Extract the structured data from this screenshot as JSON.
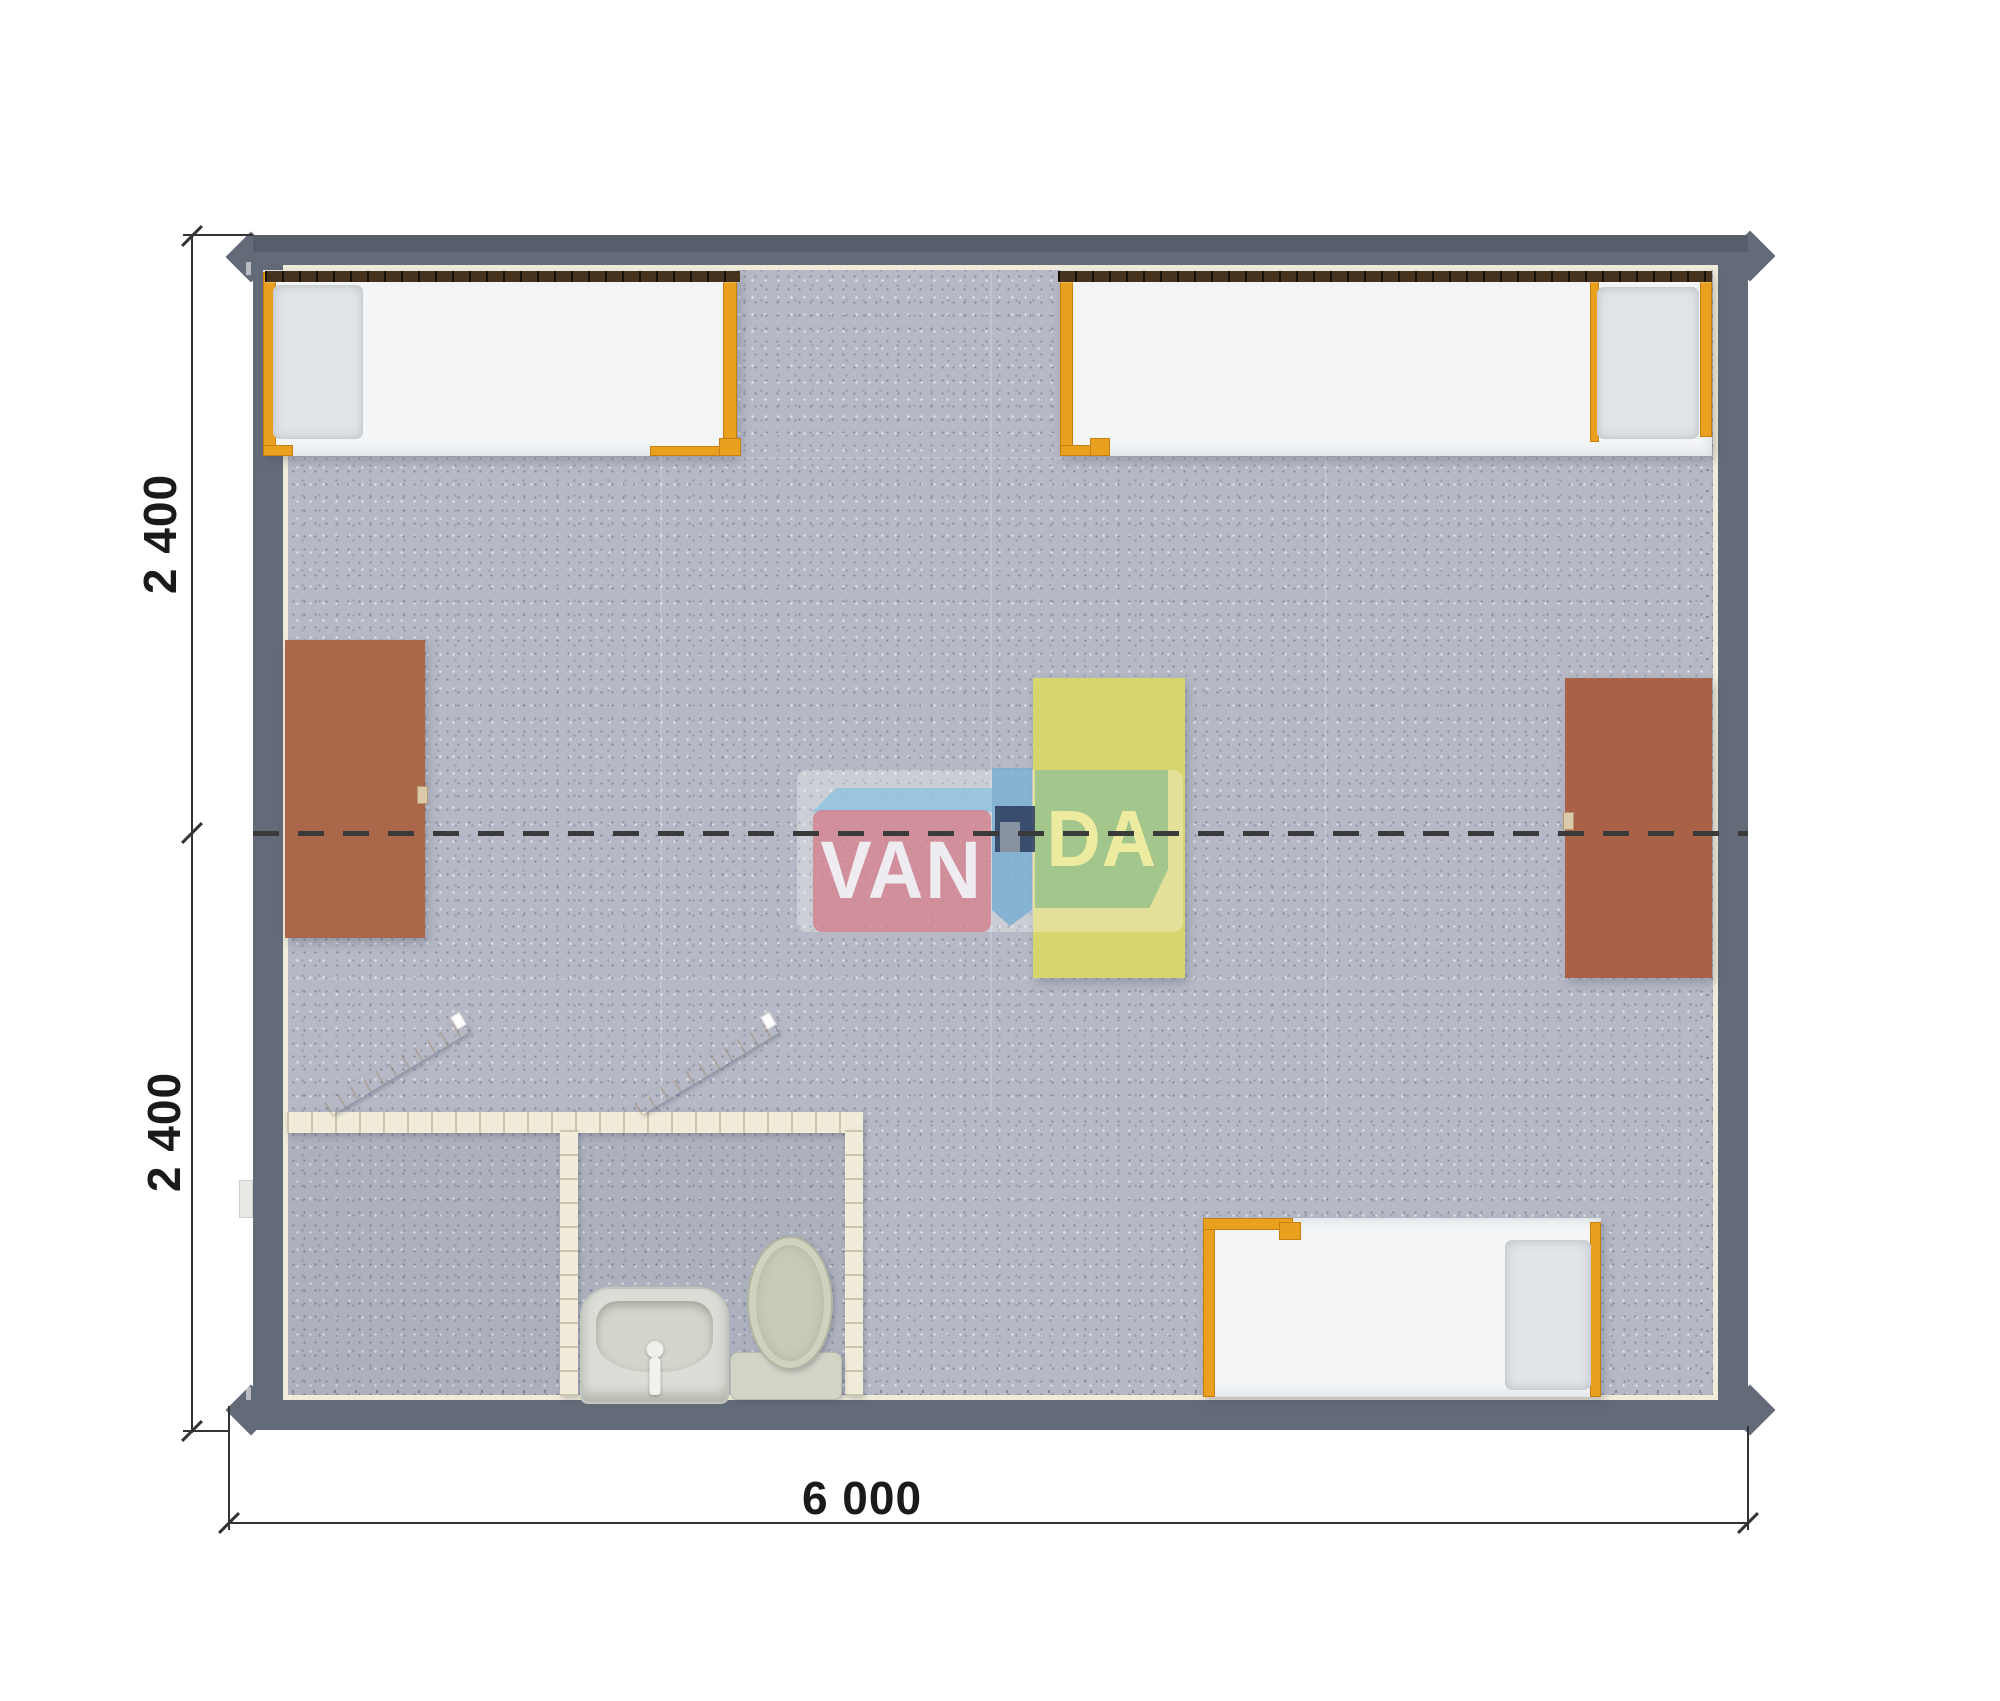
{
  "plan": {
    "watermark": {
      "part1": "VAN",
      "part2": "DA"
    },
    "dimensions": {
      "left_top": "2 400",
      "left_bottom": "2 400",
      "bottom": "6 000"
    },
    "items": [
      "bed-top-left",
      "bed-top-right",
      "bed-bottom-right",
      "desk-left",
      "desk-right",
      "table-center",
      "bathroom-shower-room",
      "bathroom-wc-room",
      "washbasin",
      "toilet",
      "door-shower",
      "door-wc"
    ]
  },
  "colors": {
    "wall": "#636a78",
    "floor": "#b6b9c5",
    "lining": "#f0ecd9",
    "orange": "#e9a01e",
    "desk": "#ab674a",
    "table": "#d7d56e",
    "mattress": "#f3f5f7",
    "pillow": "#e1e5e9",
    "headboard": "#46321d",
    "door": "#d6b37f",
    "dash": "#3a3a3a",
    "dim": "#333333",
    "wm_red": "#d27d8a",
    "wm_blue": "#8fc2df",
    "wm_navy": "#2f3f60",
    "wm_green": "#7ab482"
  }
}
